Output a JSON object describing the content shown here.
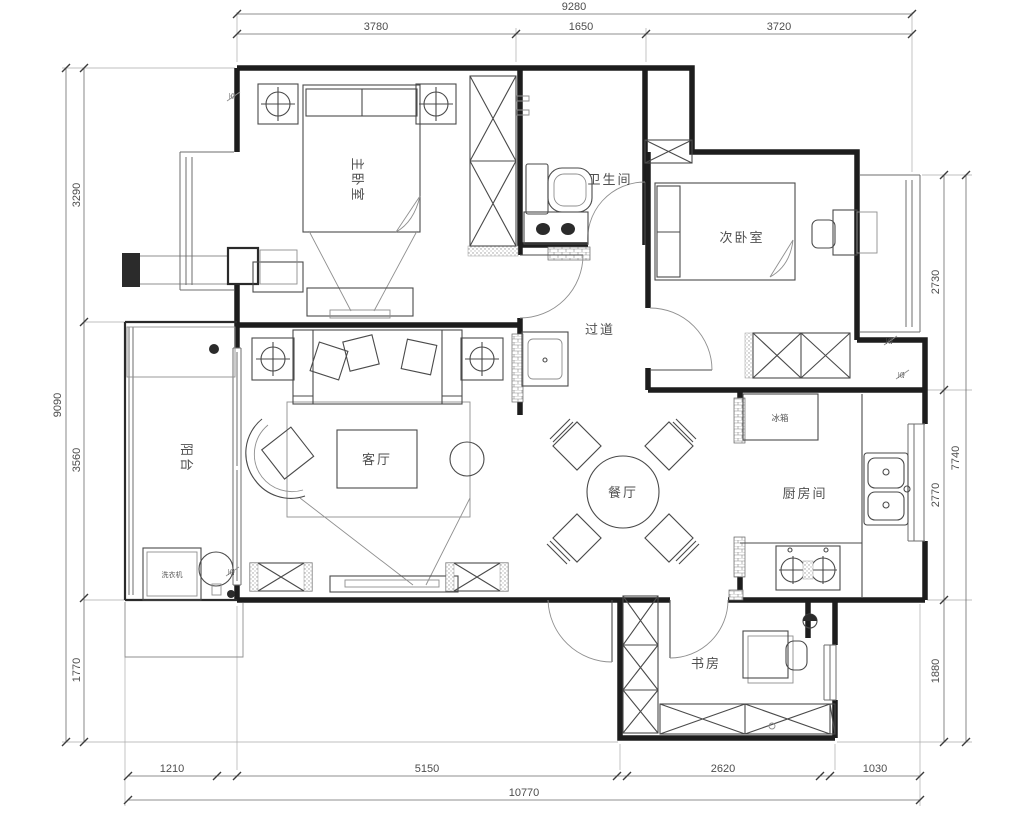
{
  "plan": {
    "rooms": {
      "master_bedroom": "主卧室",
      "bathroom": "卫生间",
      "second_bedroom": "次卧室",
      "corridor": "过道",
      "balcony": "阳台",
      "living_room": "客厅",
      "dining_room": "餐厅",
      "kitchen": "厨房间",
      "study": "书房"
    },
    "appliances": {
      "washing_machine": "洗衣机",
      "fridge": "冰箱"
    },
    "markers": {
      "ac": "空"
    },
    "dimensions": {
      "top": {
        "total": "9280",
        "segments": [
          "3780",
          "1650",
          "3720"
        ]
      },
      "left": {
        "total": "9090",
        "segments": [
          "3290",
          "3560",
          "1770"
        ]
      },
      "right": {
        "total": "7740",
        "segments": [
          "2730",
          "2770",
          "1880"
        ]
      },
      "bottom": {
        "total": "10770",
        "segments": [
          "1210",
          "5150",
          "2620",
          "1030"
        ]
      }
    },
    "colors": {
      "wall": "#1d1d1d",
      "furniture": "#4a4a4a",
      "dimension": "#4d4d4d",
      "background": "#ffffff"
    }
  }
}
